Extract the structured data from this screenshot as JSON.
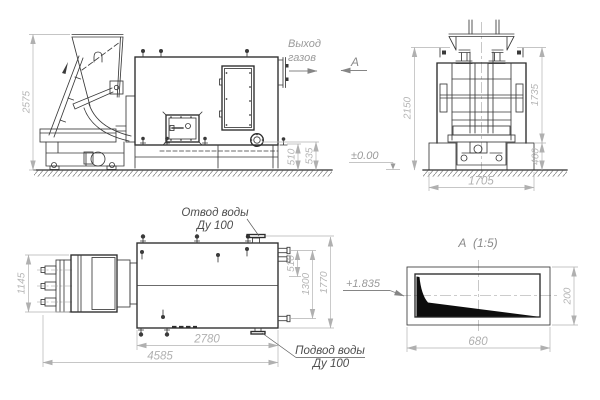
{
  "drawing": {
    "labels": {
      "gas_outlet_line1": "Выход",
      "gas_outlet_line2": "газов",
      "section_arrow": "А",
      "section_view_title": "А  (1:5)",
      "water_outlet_line1": "Отвод воды",
      "water_outlet_line2": "Ду 100",
      "water_inlet_line1": "Подвод воды",
      "water_inlet_line2": "Ду 100",
      "ground_level": "±0.00",
      "section_level": "+1.835"
    },
    "dimensions": {
      "front": {
        "overall_height": "2575",
        "outlet_height": "510",
        "flange_height": "535"
      },
      "side": {
        "hopper_height": "2150",
        "body_height": "1735",
        "foundation_height": "460",
        "foundation_width": "1705"
      },
      "plan": {
        "feeder_width": "1145",
        "fitting_offset": "510",
        "fitting_span": "1300",
        "overall_width": "1770",
        "body_length": "2780",
        "overall_length": "4585"
      },
      "section": {
        "width": "680",
        "height": "200"
      }
    },
    "colors": {
      "line": "#3a3a3a",
      "dimension": "#b3b3b3",
      "label": "#4d4d4d",
      "wedge_fill": "#0d0d0d"
    }
  }
}
